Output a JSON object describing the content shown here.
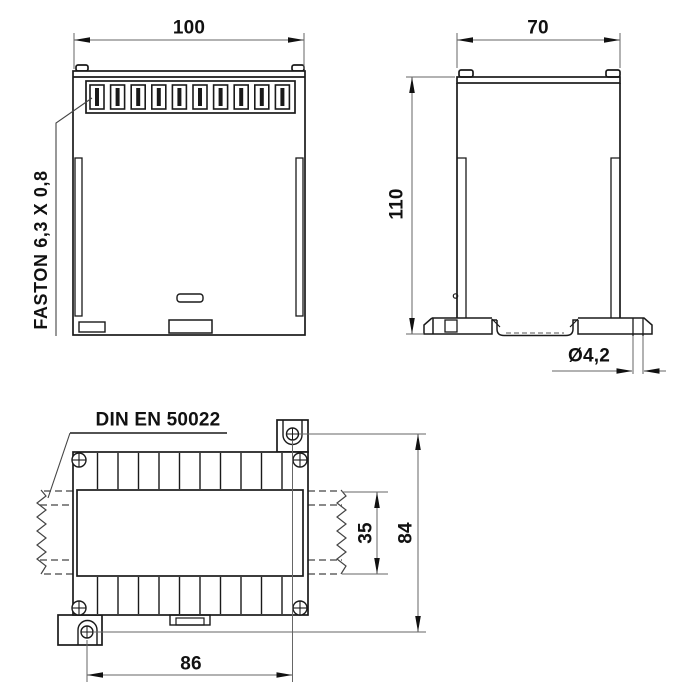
{
  "views": {
    "front": {
      "width_dim": "100",
      "terminal_label": "FASTON 6,3 X 0,8"
    },
    "side": {
      "width_dim": "70",
      "height_dim": "110",
      "mount_hole_dim": "Ø4,2"
    },
    "rear": {
      "rail_standard_label": "DIN EN 50022",
      "rail_width_dim": "35",
      "mount_pitch_vertical_dim": "84",
      "mount_pitch_horizontal_dim": "86"
    }
  },
  "colors": {
    "background": "#ffffff",
    "outline": "#1a1a1a",
    "dimension_line": "#666666",
    "text": "#111111"
  }
}
